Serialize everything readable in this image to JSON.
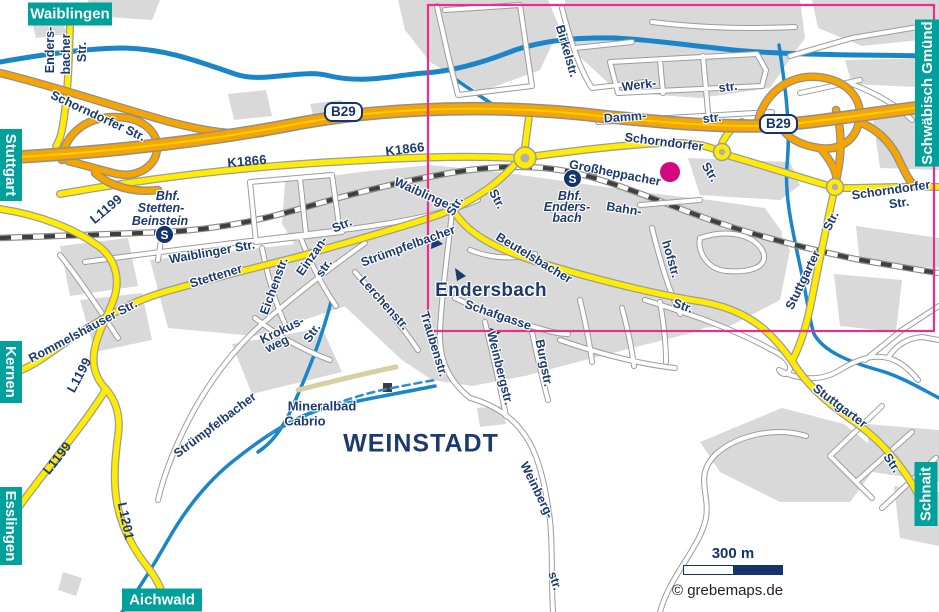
{
  "edge_labels": {
    "waiblingen": "Waiblingen",
    "stuttgart": "Stuttgart",
    "kernen": "Kernen",
    "esslingen": "Esslingen",
    "aichwald": "Aichwald",
    "schwaebisch_gmuend": "Schwäbisch Gmünd",
    "schnait": "Schnait"
  },
  "routes": {
    "b29": "B29",
    "k1866": "K1866",
    "l1199": "L1199",
    "l1201": "L1201"
  },
  "streets": {
    "schorndorfer_str": "Schorndorfer Str.",
    "schorndorfer": "Schorndorfer",
    "str": "Str.",
    "str_lower": "str.",
    "waiblinger_str": "Waiblinger Str.",
    "waiblinger": "Waiblinger",
    "stettener": "Stettener",
    "rommelshaeuser_str": "Rommelshäuser Str.",
    "endersbacher_1": "Enders-",
    "endersbacher_2": "bacher",
    "eichenstr": "Eichenstr.",
    "einzan": "Einzan-",
    "krokus": "Krokus-",
    "weg": "weg",
    "lerchenstr": "Lerchenstr.",
    "struempfelbacher": "Strümpfelbacher",
    "beutelsbacher": "Beutelsbacher",
    "schafgasse": "Schafgasse",
    "traubenstr": "Traubenstr.",
    "weinbergstr": "Weinbergstr.",
    "burgstr": "Burgstr.",
    "weinberg": "Weinberg-",
    "grossheppacher": "Großheppacher",
    "bahn": "Bahn-",
    "hofstr": "hofstr.",
    "stuttgarter": "Stuttgarter",
    "birkelstr": "Birkelstr.",
    "werk": "Werk-",
    "damm": "Damm-"
  },
  "places": {
    "endersbach": "Endersbach",
    "weinstadt": "WEINSTADT",
    "mineralbad_1": "Mineralbad",
    "mineralbad_2": "Cabrio"
  },
  "stations": {
    "icon": "S",
    "stetten_1": "Bhf.",
    "stetten_2": "Stetten-",
    "stetten_3": "Beinstein",
    "endersbach_1": "Bhf.",
    "endersbach_2": "Enders-",
    "endersbach_3": "bach"
  },
  "scale": {
    "label": "300 m"
  },
  "attribution": "© grebemaps.de",
  "colors": {
    "selection_pink": "#ea2e8b",
    "poi_magenta": "#d4077f",
    "edge_teal": "#00a09b",
    "label_navy": "#1c3a6e",
    "road_yellow": "#ffec00",
    "highway_orange": "#f5a400",
    "river_blue": "#1a85c8",
    "urban_gray": "#d9d9d9"
  }
}
